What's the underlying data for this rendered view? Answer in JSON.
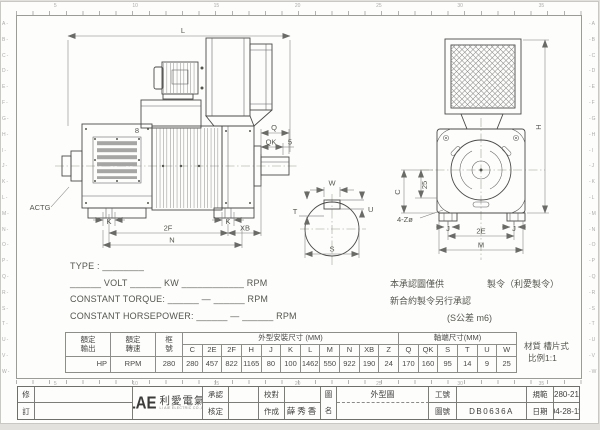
{
  "colors": {
    "line": "#4a4a48",
    "dim_line": "#7b7b77",
    "text": "#55554f",
    "louver_fill": "#a6a6a4"
  },
  "rulers": {
    "top_numbers": [
      "5",
      "10",
      "15",
      "20",
      "25",
      "30",
      "35"
    ],
    "bottom_numbers": [
      "5",
      "10",
      "15",
      "20",
      "25",
      "30",
      "35"
    ],
    "left_letters": [
      "A",
      "B",
      "C",
      "D",
      "E",
      "F",
      "G",
      "H",
      "I",
      "J",
      "K",
      "L",
      "M",
      "N",
      "O",
      "P",
      "Q",
      "R",
      "S",
      "T",
      "U",
      "V",
      "W"
    ],
    "right_letters": [
      "A",
      "B",
      "C",
      "D",
      "E",
      "F",
      "G",
      "H",
      "I",
      "J",
      "K",
      "L",
      "M",
      "N",
      "O",
      "P",
      "Q",
      "R",
      "S",
      "T",
      "U",
      "V",
      "W"
    ]
  },
  "side_view": {
    "l": "L",
    "q": "Q",
    "qk": "QK",
    "five": "5",
    "eight": "8",
    "k_left": "K",
    "k_right": "K",
    "f2": "2F",
    "xb": "XB",
    "n": "N",
    "actg": "ACTG"
  },
  "shaft_view": {
    "w": "W",
    "t": "T",
    "u": "U",
    "s": "S"
  },
  "end_view": {
    "h": "H",
    "c": "C",
    "v25": "25",
    "holes": "4-Zø",
    "j_left": "J",
    "j_right": "J",
    "e2": "2E",
    "m": "M"
  },
  "spec": {
    "line1": "TYPE : ________",
    "line2": "______ VOLT ______ KW ____________ RPM",
    "line3": "CONSTANT TORQUE: ______ — ______ RPM",
    "line4": "CONSTANT HORSEPOWER: ______ — ______ RPM"
  },
  "notes": {
    "approval1": "本承認圖僅供",
    "approval2": "新合約製令另行承認",
    "order": "製令（利愛製令）",
    "tolerance": "(S公差 m6)",
    "material": "材質 槽片式",
    "scale": "比例1:1"
  },
  "table": {
    "out_l1": "額定",
    "out_l2": "輸出",
    "spd_l1": "額定",
    "spd_l2": "轉速",
    "frm_l1": "框",
    "frm_l2": "號",
    "group_outline": "外型安裝尺寸 (MM)",
    "group_shaft": "軸端尺寸(MM)",
    "col_headers": [
      "C",
      "2E",
      "2F",
      "H",
      "J",
      "K",
      "L",
      "M",
      "N",
      "XB",
      "Z",
      "Q",
      "QK",
      "S",
      "T",
      "U",
      "W"
    ],
    "val_output": "HP",
    "val_speed": "RPM",
    "val_frame": "280",
    "values": [
      "280",
      "457",
      "822",
      "1165",
      "80",
      "100",
      "1462",
      "550",
      "922",
      "190",
      "24",
      "170",
      "160",
      "95",
      "14",
      "9",
      "25"
    ]
  },
  "title_block": {
    "rev_top": "修",
    "rev_bottom": "訂",
    "logo": "LAE",
    "logo_cjk": "利愛電氣",
    "logo_sub": "LI AIE ELECTRIC CO.,LTD",
    "approve": "承認",
    "authorize": "核定",
    "proofread": "校對",
    "made": "作成",
    "made_value": "薛秀香",
    "name_l1": "圖",
    "name_l2": "名",
    "name_value": "外型圖",
    "work_no": "工號",
    "work_no_value": "",
    "dwg_no": "圖號",
    "dwg_no_value": "DB0636A",
    "spec": "規範",
    "spec_value": "280-21",
    "date": "日期",
    "date_value": "04-28-11"
  }
}
